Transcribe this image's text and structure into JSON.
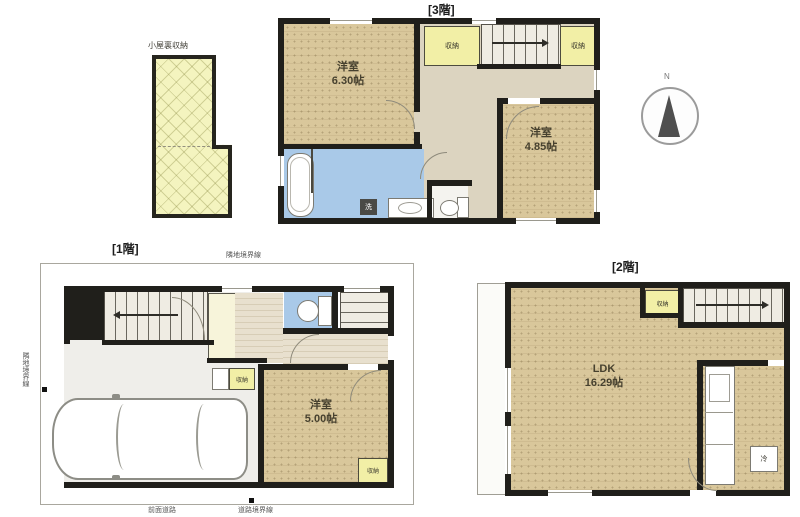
{
  "floor3": {
    "title": "[3階]",
    "room_a_name": "洋室",
    "room_a_size": "6.30帖",
    "room_b_name": "洋室",
    "room_b_size": "4.85帖",
    "closet_left": "収納",
    "closet_right": "収納",
    "washer": "洗"
  },
  "attic": {
    "label": "小屋裏収納"
  },
  "compass": {
    "north": "N"
  },
  "floor1": {
    "title": "[1階]",
    "room_a_name": "洋室",
    "room_a_size": "5.00帖",
    "closet": "収納",
    "nook": "収納",
    "boundary_top": "隣地境界線",
    "boundary_left": "隣地境界線",
    "boundary_bottom": "道路境界線",
    "road": "前面道路"
  },
  "floor2": {
    "title": "[2階]",
    "room_name": "LDK",
    "room_size": "16.29帖",
    "closet": "収納",
    "fridge": "冷"
  },
  "colors": {
    "floor_tatami": "#d9c79b",
    "wet_area": "#a9c9e8",
    "closet_yellow": "#f2efa6",
    "attic_yellow": "#f4f4bf",
    "wall": "#201f1b"
  }
}
